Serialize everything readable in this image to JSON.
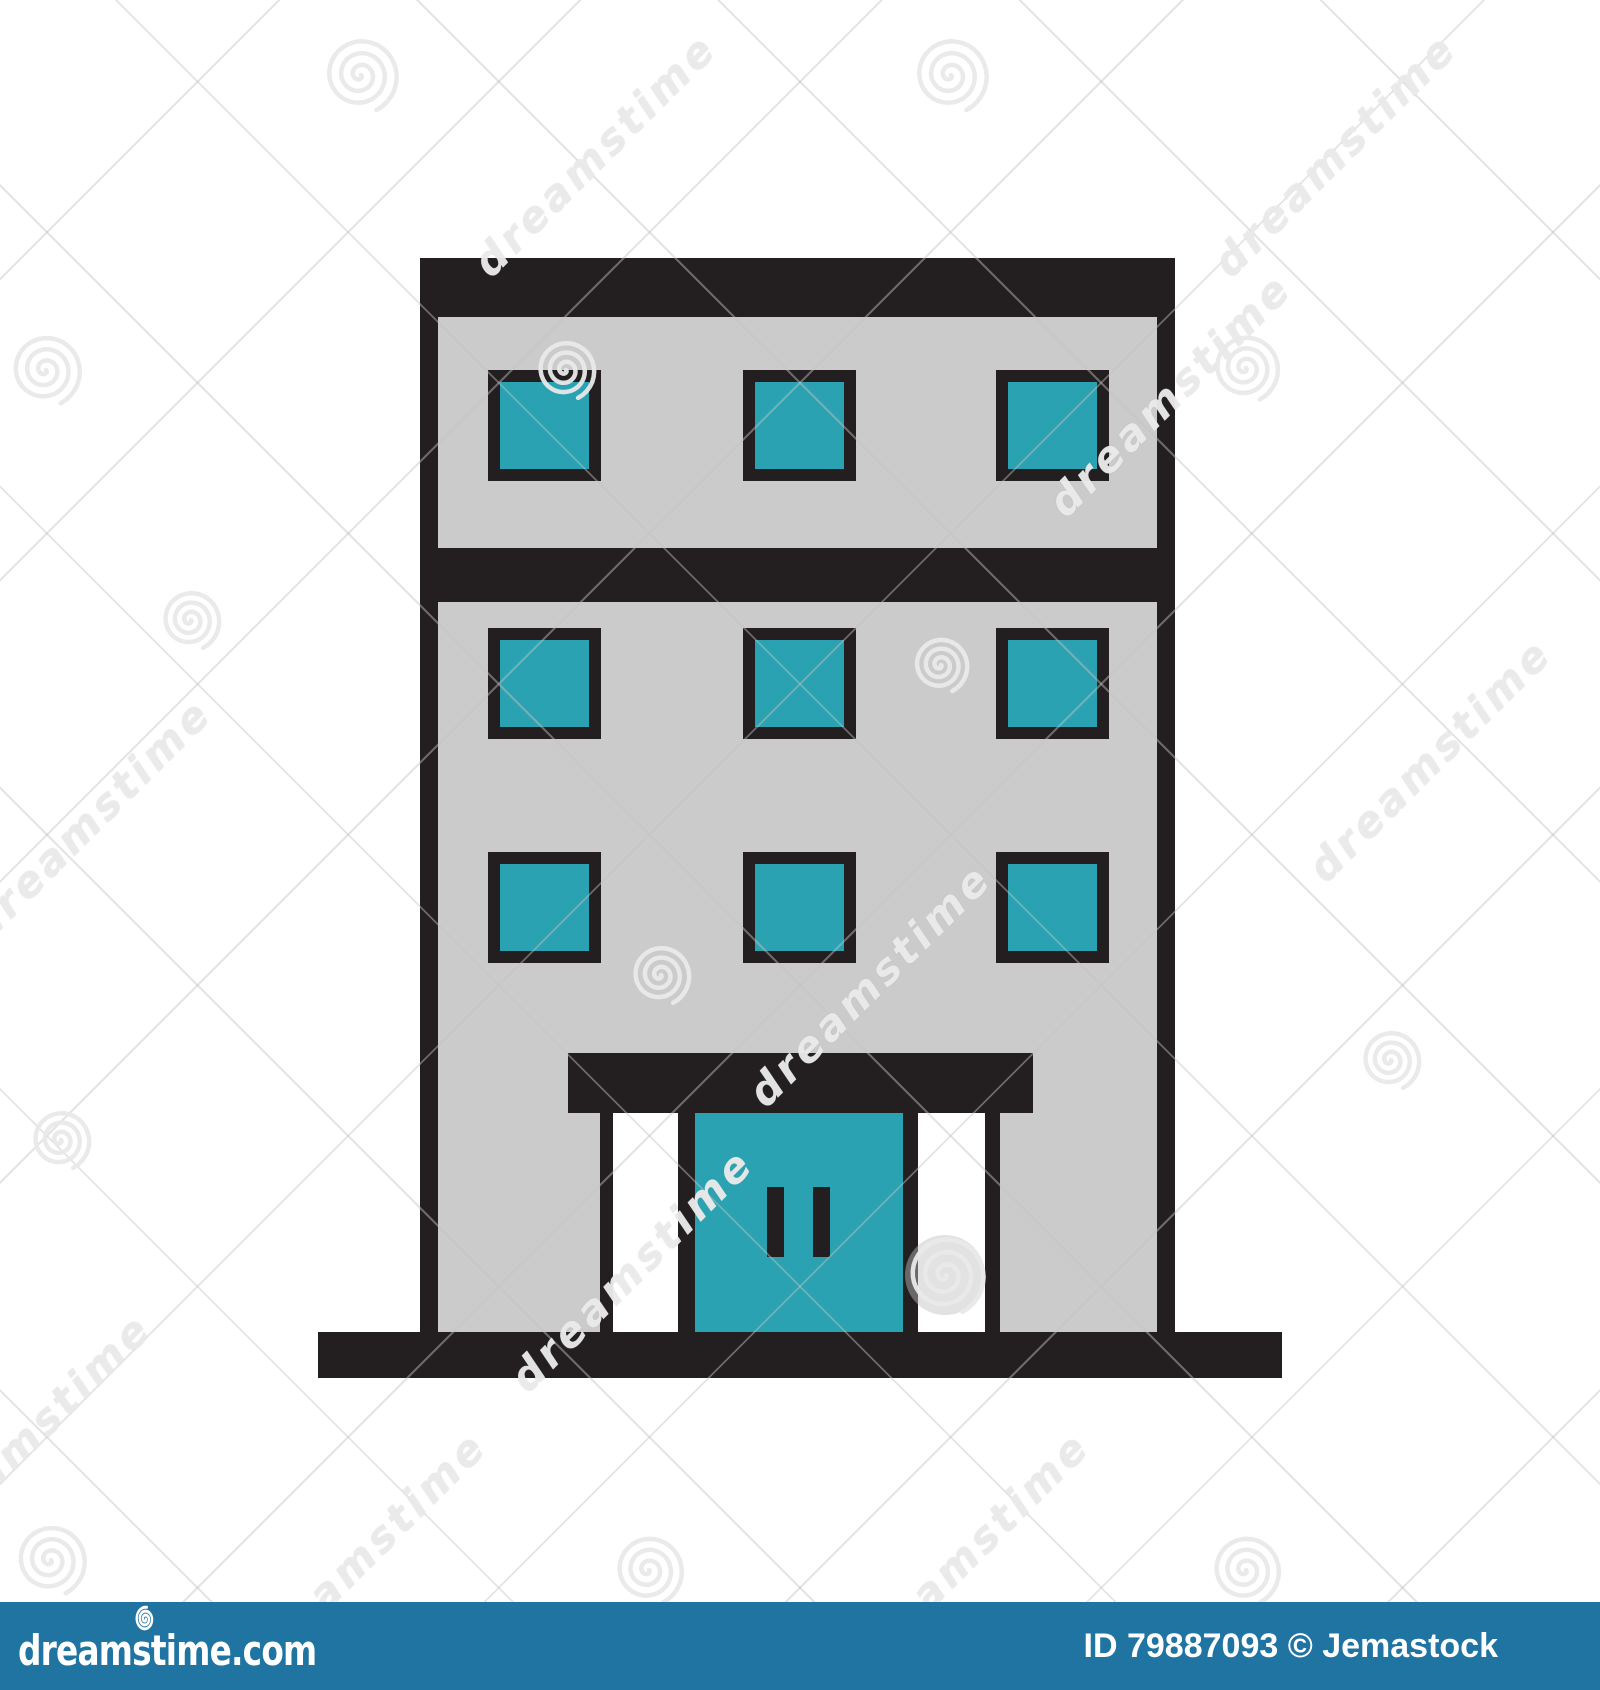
{
  "illustration": {
    "label": "flat building icon",
    "colors": {
      "outline": "#231F20",
      "wall": "#CBCBCB",
      "window_glass": "#2AA2B1",
      "pillar": "#FFFFFF",
      "background": "#FFFFFF"
    },
    "window_grid": {
      "rows": 3,
      "cols": 3
    }
  },
  "watermark": {
    "text": "dreamstime",
    "text_instances": [
      {
        "x": 595,
        "y": 155
      },
      {
        "x": 1335,
        "y": 155
      },
      {
        "x": 1170,
        "y": 395
      },
      {
        "x": 90,
        "y": 820
      },
      {
        "x": 1430,
        "y": 760
      },
      {
        "x": 870,
        "y": 985
      },
      {
        "x": 632,
        "y": 1270
      },
      {
        "x": 30,
        "y": 1435
      },
      {
        "x": 365,
        "y": 1553
      },
      {
        "x": 968,
        "y": 1553
      }
    ],
    "spiral_instances": [
      {
        "x": 360,
        "y": 75,
        "r": 38
      },
      {
        "x": 950,
        "y": 75,
        "r": 38
      },
      {
        "x": 45,
        "y": 370,
        "r": 36
      },
      {
        "x": 565,
        "y": 370,
        "r": 30
      },
      {
        "x": 1245,
        "y": 368,
        "r": 34
      },
      {
        "x": 190,
        "y": 620,
        "r": 30
      },
      {
        "x": 940,
        "y": 665,
        "r": 28
      },
      {
        "x": 660,
        "y": 975,
        "r": 30
      },
      {
        "x": 1390,
        "y": 1060,
        "r": 30
      },
      {
        "x": 945,
        "y": 1275,
        "r": 40,
        "filled": true
      },
      {
        "x": 60,
        "y": 1140,
        "r": 30
      },
      {
        "x": 50,
        "y": 1560,
        "r": 36
      },
      {
        "x": 648,
        "y": 1570,
        "r": 35
      },
      {
        "x": 1245,
        "y": 1570,
        "r": 35
      }
    ]
  },
  "footer": {
    "logo_text": "dreamstime.com",
    "credit_text": "ID 79887093 © Jemastock",
    "bar_color": "#2074A1"
  }
}
